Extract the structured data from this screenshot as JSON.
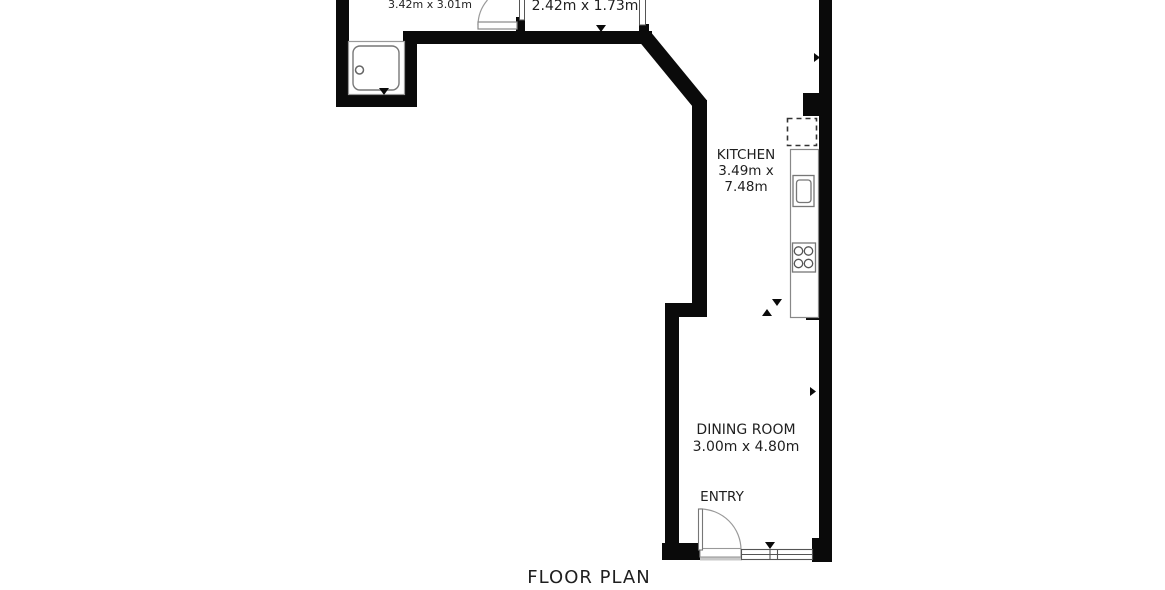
{
  "title": "FLOOR PLAN",
  "colors": {
    "background": "#ffffff",
    "wall": "#0a0a0a",
    "fixture_line": "#777777",
    "door_arc": "#9a9a9a",
    "threshold_shadow": "#c8c8c8",
    "text": "#1f1f1f"
  },
  "rooms": {
    "bathroom": {
      "dimensions": "3.42m x 3.01m"
    },
    "small_room": {
      "dimensions": "2.42m x 1.73m"
    },
    "kitchen": {
      "name": "KITCHEN",
      "dim_line1": "3.49m x",
      "dim_line2": "7.48m"
    },
    "dining": {
      "name": "DINING ROOM",
      "dimensions": "3.00m x 4.80m"
    },
    "entry": {
      "name": "ENTRY"
    }
  },
  "symbols": {
    "shower": "shower-tray-with-drain",
    "sink": "kitchen-sink",
    "hob": "cooktop-4-burner",
    "appliance_space": "dashed-appliance-box",
    "doors": "door-swing-arc",
    "window": "double-line-window",
    "dimension_markers": "black-triangle-arrows"
  }
}
